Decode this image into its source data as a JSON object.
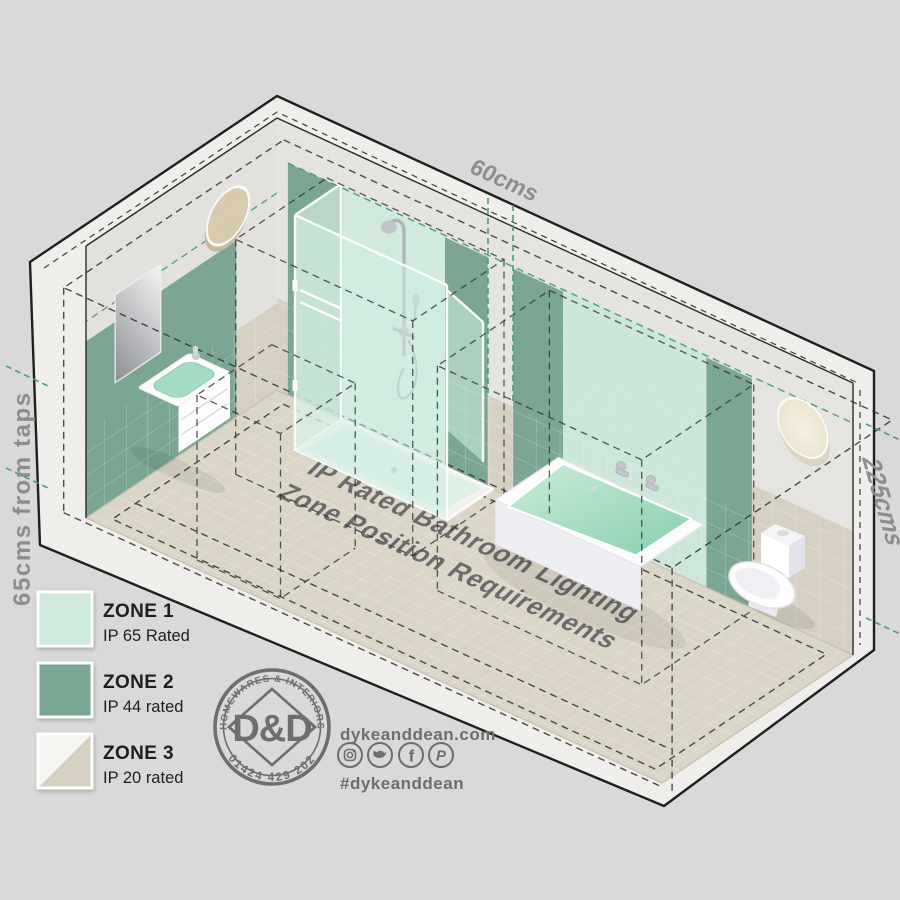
{
  "scene": {
    "floor_title_line1": "IP Rated Bathroom Lighting",
    "floor_title_line2": "Zone Position Requirements"
  },
  "dimensions": {
    "top": "60cms",
    "left": "65cms from taps",
    "right": "225cms"
  },
  "legend": {
    "items": [
      {
        "zone": "ZONE 1",
        "rating": "IP 65 Rated",
        "color": "#cfeadd"
      },
      {
        "zone": "ZONE 2",
        "rating": "IP 44 rated",
        "color": "#79a693"
      },
      {
        "zone": "ZONE 3",
        "rating": "IP 20 rated",
        "color": "#d5d0c2"
      }
    ]
  },
  "logo": {
    "arc_top": "HOMEWARES & INTERIORS",
    "arc_bottom": "01424 429 202",
    "monogram": "D&D"
  },
  "contact": {
    "website": "dykeanddean.com",
    "hashtag": "#dykeanddean",
    "social": [
      "instagram",
      "twitter",
      "facebook",
      "pinterest"
    ]
  },
  "colors": {
    "background": "#d8d9d8",
    "zone1_mint": "#cfeadd",
    "zone2_green": "#79a693",
    "zone3_beige": "#d5d0c2",
    "concrete": "#e9e8e4",
    "tile": "#d8d3c4",
    "teal_dash": "#4a9c86",
    "dim_text": "#8d8d8d",
    "brand_gray": "#6e6e6e"
  }
}
